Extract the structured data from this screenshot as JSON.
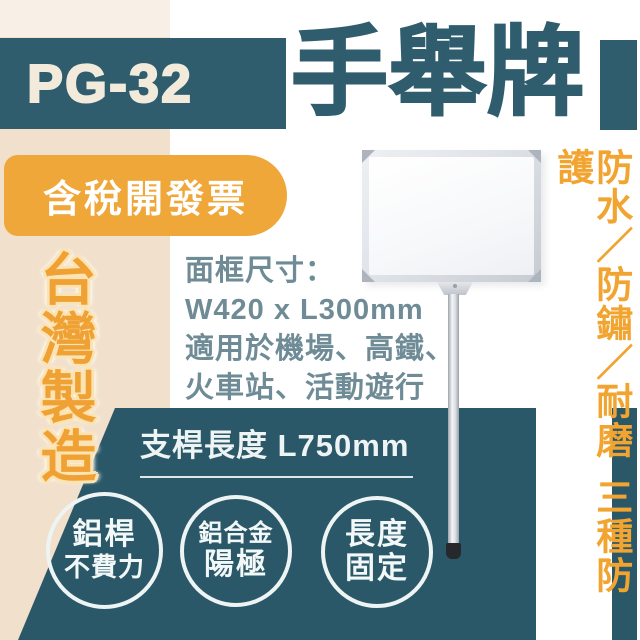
{
  "model_code": "PG-32",
  "title": "手舉牌",
  "badges": {
    "tax_invoice": "含稅開發票",
    "origin": "台灣製造"
  },
  "specs": [
    "面框尺寸：",
    "W420 x L300mm",
    "適用於機場、高鐵、",
    "火車站、活動遊行"
  ],
  "pole_length_label": "支桿長度 L750mm",
  "feature_circles": [
    {
      "line1": "鋁桿",
      "line2": "不費力"
    },
    {
      "line1": "鋁合金",
      "line2": "陽極"
    },
    {
      "line1": "長度",
      "line2": "固定"
    }
  ],
  "side_note": {
    "features": "防水／防鏽／耐磨",
    "summary": "三種防護"
  },
  "colors": {
    "teal": "#2f5d6e",
    "teal_dark": "#2b5868",
    "orange": "#f0a739",
    "orange_text": "#f2a431",
    "cream_light": "#f8efe6",
    "cream": "#f1e0cb",
    "slate_text": "#6e8b96",
    "white": "#ffffff"
  }
}
